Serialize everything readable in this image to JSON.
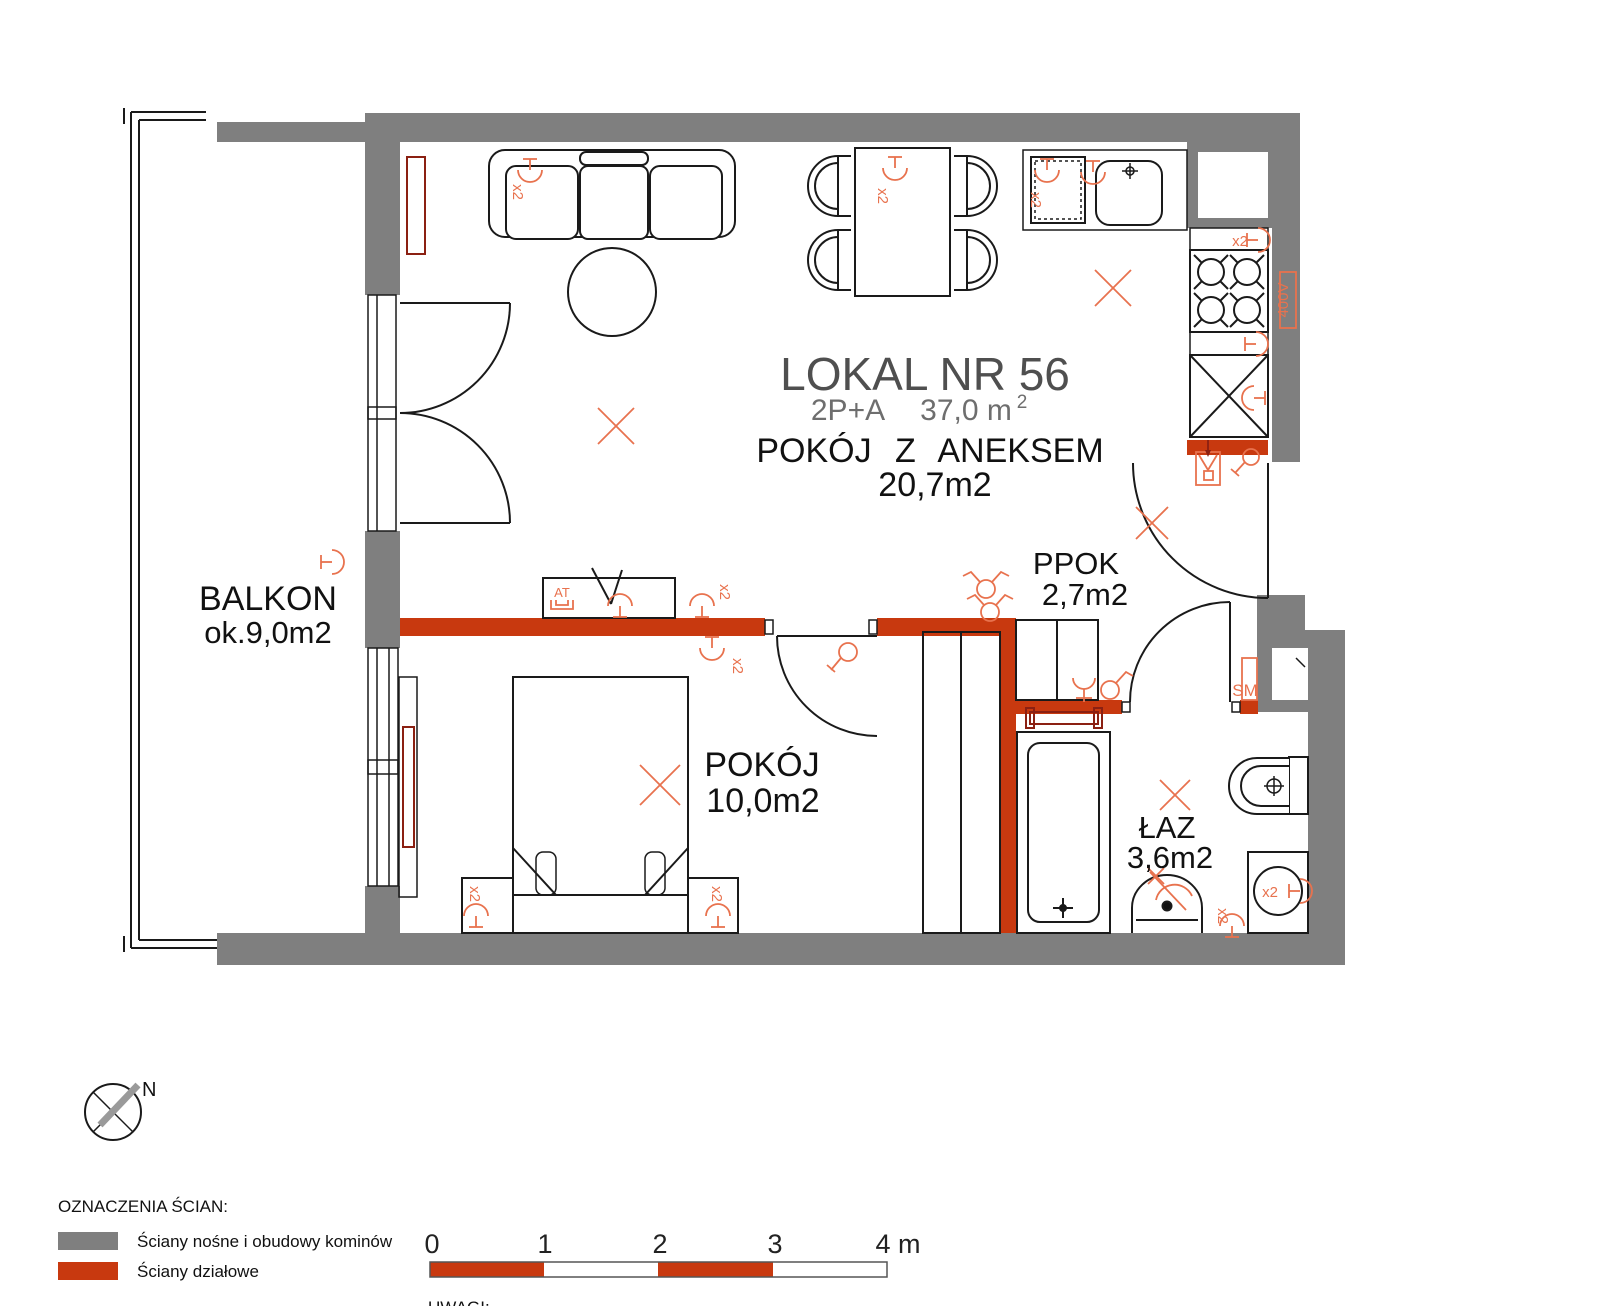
{
  "unit": {
    "title": "LOKAL NR 56",
    "type": "2P+A",
    "area": "37,0 m",
    "area_sup": "2"
  },
  "rooms": {
    "aneks": {
      "name": "POKÓJ Z ANEKSEM",
      "area": "20,7m2"
    },
    "pokoj": {
      "name": "POKÓJ",
      "area": "10,0m2"
    },
    "ppok": {
      "name": "PPOK",
      "area": "2,7m2"
    },
    "laz": {
      "name": "ŁAZ",
      "area": "3,6m2"
    },
    "balkon": {
      "name": "BALKON",
      "area": "ok.9,0m2"
    }
  },
  "symbols": {
    "double_socket": "x2",
    "power_400v": "400V",
    "smoke_detector": "SM",
    "antenna": "AT"
  },
  "compass": {
    "north": "N"
  },
  "legend": {
    "heading": "OZNACZENIA ŚCIAN:",
    "load_bearing": "Ściany nośne i obudowy kominów",
    "partition": "Ściany działowe"
  },
  "scalebar": {
    "t0": "0",
    "t1": "1",
    "t2": "2",
    "t3": "3",
    "t4": "4 m"
  },
  "notes_heading": "UWAGI:",
  "colors": {
    "wall_gray": "#7f7f7f",
    "wall_red": "#c8390f",
    "symbol_orange": "#e8724e",
    "radiator_maroon": "#8b2012"
  }
}
